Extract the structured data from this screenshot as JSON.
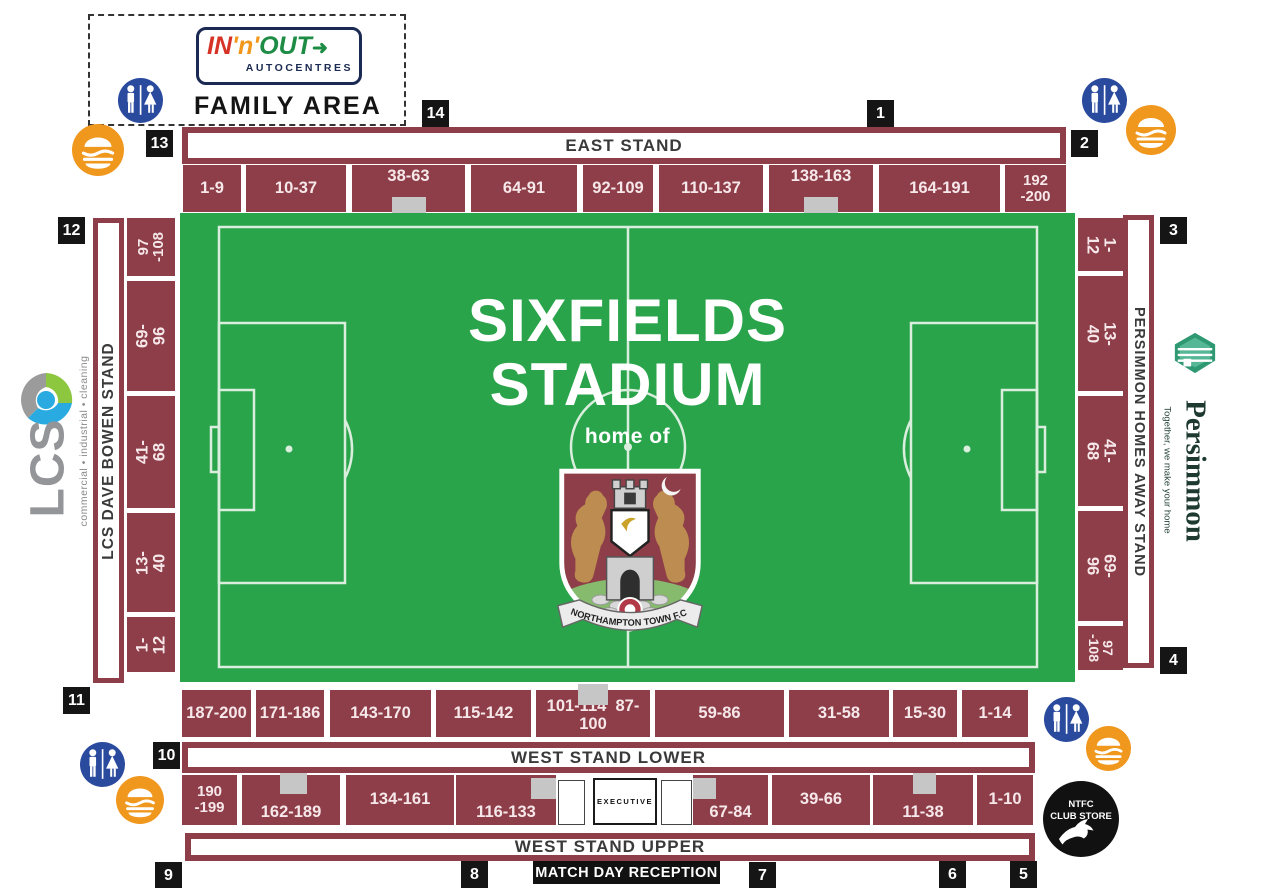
{
  "family_area": {
    "label": "FAMILY AREA",
    "sponsor": {
      "part_in": "IN",
      "part_n": "'n'",
      "part_out": "OUT",
      "arrow": "➜",
      "subtitle": "AUTOCENTRES"
    }
  },
  "pitch": {
    "title_line1": "SIXFIELDS",
    "title_line2": "STADIUM",
    "subtitle": "home of",
    "crest_banner": "NORTHAMPTON TOWN F.C."
  },
  "stands": {
    "east": {
      "name": "EAST STAND",
      "blocks": [
        "1-9",
        "10-37",
        "38-63",
        "64-91",
        "92-109",
        "110-137",
        "138-163",
        "164-191",
        "192\n-200"
      ]
    },
    "west_lower": {
      "name": "WEST STAND LOWER",
      "blocks": [
        "187-200",
        "171-186",
        "143-170",
        "115-142",
        "101-114  87-100",
        "59-86",
        "31-58",
        "15-30",
        "1-14"
      ]
    },
    "west_upper": {
      "name": "WEST STAND UPPER",
      "executive_label": "EXECUTIVE",
      "blocks": [
        "190\n-199",
        "162-189",
        "134-161",
        "116-133",
        "67-84",
        "39-66",
        "11-38",
        "1-10"
      ]
    },
    "dave_bowen": {
      "name": "LCS DAVE BOWEN STAND",
      "blocks": [
        "97\n-108",
        "69-96",
        "41-68",
        "13-40",
        "1-12"
      ]
    },
    "away": {
      "name": "PERSIMMON HOMES AWAY STAND",
      "blocks": [
        "1-12",
        "13-40",
        "41-68",
        "69-96",
        "97\n-108"
      ]
    }
  },
  "gates": [
    "1",
    "2",
    "3",
    "4",
    "5",
    "6",
    "7",
    "8",
    "9",
    "10",
    "11",
    "12",
    "13",
    "14"
  ],
  "facilities": {
    "match_day_reception": "MATCH DAY RECEPTION",
    "club_store": {
      "line1": "NTFC",
      "line2": "CLUB STORE"
    }
  },
  "sponsors": {
    "lcs": {
      "name": "LCS",
      "tagline": "commercial • industrial • cleaning"
    },
    "persimmon": {
      "name": "Persimmon",
      "tagline": "Together, we make your home"
    }
  },
  "colors": {
    "block_maroon": "#8e3e48",
    "pitch_green": "#2aa44a",
    "pitch_line": "#d9eedd",
    "gate_black": "#151515",
    "toilet_blue": "#2a4a9e",
    "food_orange": "#f0971e",
    "notch_grey": "#c6c6c6"
  }
}
